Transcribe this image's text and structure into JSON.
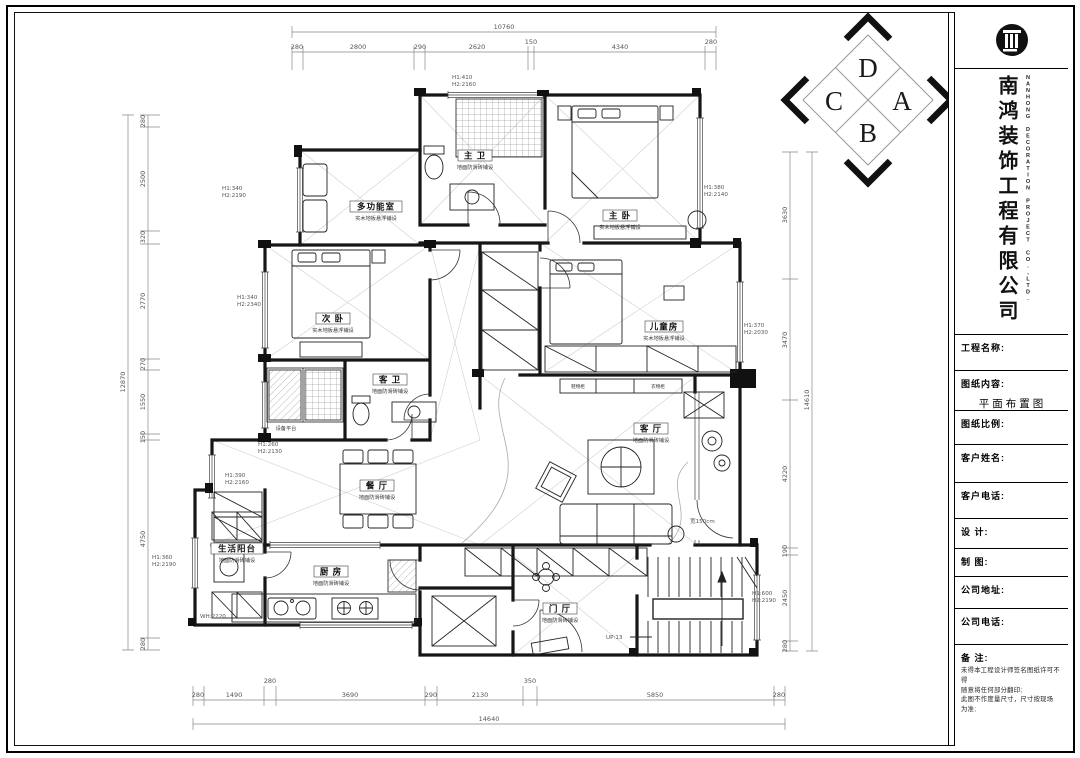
{
  "title_block": {
    "company_cn": "南鸿装饰工程有限公司",
    "company_en": "NANHONG DECORATION PROJECT CO.,LTD.",
    "fields": [
      {
        "label": "工程名称:",
        "value": ""
      },
      {
        "label": "图纸内容:",
        "value": "平面布置图"
      },
      {
        "label": "图纸比例:",
        "value": ""
      },
      {
        "label": "客户姓名:",
        "value": ""
      },
      {
        "label": "客户电话:",
        "value": ""
      },
      {
        "label": "设  计:",
        "value": ""
      },
      {
        "label": "制  图:",
        "value": ""
      },
      {
        "label": "公司地址:",
        "value": ""
      },
      {
        "label": "公司电话:",
        "value": ""
      }
    ],
    "remark": {
      "label": "备  注:",
      "lines": [
        "未得本工程设计师签名图纸许可不得",
        "随意将任何部分翻印;",
        "此图不作度量尺寸，尺寸按现场",
        "为准;"
      ]
    }
  },
  "compass": {
    "top": "D",
    "right": "A",
    "bottom": "B",
    "left": "C"
  },
  "rooms": {
    "master_bath": {
      "name": "主 卫",
      "note": "地面防滑砖铺设"
    },
    "multi_room": {
      "name": "多功能室",
      "note": "实木地板悬浮铺设"
    },
    "master_bed": {
      "name": "主 卧",
      "note": "实木地板悬浮铺设"
    },
    "second_bed": {
      "name": "次 卧",
      "note": "实木地板悬浮铺设"
    },
    "kids_room": {
      "name": "儿童房",
      "note": "实木地板悬浮铺设"
    },
    "guest_bath": {
      "name": "客 卫",
      "note": "地面防滑砖铺设"
    },
    "dining": {
      "name": "餐 厅",
      "note": "地面防滑砖铺设"
    },
    "living": {
      "name": "客 厅",
      "note": "地面防滑砖铺设"
    },
    "kitchen": {
      "name": "厨 房",
      "note": "地面防滑砖铺设"
    },
    "balcony_service": {
      "name": "生活阳台",
      "note": "地面防滑砖铺设"
    },
    "foyer": {
      "name": "门 厅",
      "note": "地面防滑砖铺设"
    },
    "equipment": {
      "name": "设备平台",
      "note": ""
    }
  },
  "cabinets": [
    "鞋物柜",
    "衣物柜"
  ],
  "dims": {
    "top": {
      "total": "10760",
      "segments": [
        "280",
        "2800",
        "290",
        "2620",
        "150",
        "4340",
        "280"
      ]
    },
    "bottom": {
      "total": "14640",
      "segments": [
        "280",
        "1490",
        "280",
        "3690",
        "290",
        "2130",
        "350",
        "5850",
        "280"
      ]
    },
    "left": {
      "total": "12870",
      "segments": [
        "280",
        "2500",
        "320",
        "2770",
        "270",
        "1550",
        "150",
        "4750",
        "280"
      ]
    },
    "right": {
      "total": "14610",
      "segments": [
        "3630",
        "3470",
        "4220",
        "190",
        "2450",
        "280"
      ]
    }
  },
  "windows": [
    {
      "location": "top-master-bath",
      "h1": "H1:410",
      "h2": "H2:2160"
    },
    {
      "location": "left-multi-room",
      "h1": "H1:340",
      "h2": "H2:2190"
    },
    {
      "location": "left-second-bed",
      "h1": "H1:340",
      "h2": "H2:2340"
    },
    {
      "location": "right-master-bed",
      "h1": "H1:380",
      "h2": "H2:2140"
    },
    {
      "location": "right-kids-room",
      "h1": "H1:370",
      "h2": "H2:2030"
    },
    {
      "location": "left-equipment",
      "h1": "H1:260",
      "h2": "H2:2130"
    },
    {
      "location": "left-dining",
      "h1": "H1:390",
      "h2": "H2:2160"
    },
    {
      "location": "left-balcony",
      "h1": "H1:360",
      "h2": "H2:2190"
    },
    {
      "location": "right-stairs",
      "h1": "H1:600",
      "h2": "H2:2190"
    }
  ],
  "notes": {
    "kitchen_window": "WH:2220",
    "stairs": "UP:13",
    "balcony_width": "宽150cm"
  }
}
